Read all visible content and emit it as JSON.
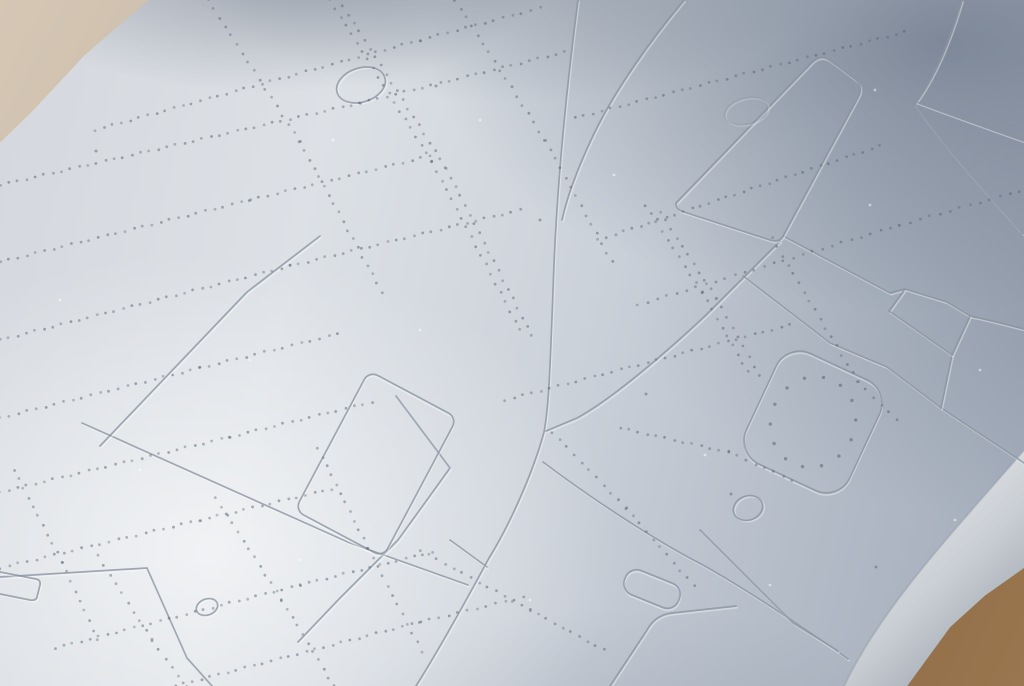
{
  "scene": {
    "subject": "macro-photo-of-grey-plastic-scale-model-part",
    "surface": "light grey injection-moulded plastic with engraved panel lines and recessed rivet rows",
    "backdrop_top_left": "blurred beige-grey tabletop",
    "backdrop_bottom_right": "warm brown tabletop"
  },
  "palette": {
    "surface_bright": "#e0e4e9",
    "surface_mid": "#ccd2da",
    "surface_shadow": "#97a1b0",
    "engraved_line": "#8a93a0",
    "emboss_highlight": "#ffffff",
    "rivet": "#59636f",
    "backdrop_beige": "#d2c4b1",
    "backdrop_shadow": "#6f6c6a",
    "table_brown": "#7d5c3c",
    "table_brown_light": "#99764e",
    "edge_band_stops": [
      [
        "0",
        "#e7e9eb"
      ],
      [
        "0.5",
        "#c9ced4"
      ],
      [
        "1",
        "#9ba2ab"
      ]
    ],
    "edge_crease": "#97a0ab",
    "edge_outline": "#8d949c"
  },
  "geometry": {
    "edge": {
      "band": "M1024,450 C955,530 882,606 844,686 L910,686 C950,632 988,598 1024,576 Z",
      "band_grad": [
        868,
        515,
        1005,
        660
      ],
      "crease": "M1024,450 C955,530 882,606 844,686",
      "outer": "M1024,576 C988,598 950,632 910,686"
    },
    "panel_lines": [
      "M578,0 C566,92 556,192 553,292 C550,368 549,406 544,432 C533,473 509,526 489,558 C468,597 438,651 416,686",
      "M684,0 C652,38 613,92 591,140 C577,170 567,197 562,220",
      "M780,241 L706,315 C672,347 614,398 577,418 L546,431",
      "M783,236 L890,293 L904,289",
      "M743,276 L830,343 L887,367 L941,408 L1024,463",
      "M952,355 L941,408",
      "M970,316 C990,320 1008,325 1024,329",
      "M962,0 C952,34 938,72 916,102",
      "M916,102 C948,114 990,129 1024,141",
      "M914,104 C941,143 986,193 1023,234",
      "M82,423 L350,543 L468,585",
      "M396,396 L450,468 L398,540 L340,598 L298,642",
      "M100,446 L247,292 L320,236",
      "M0,577 L147,568 L187,658 L212,686",
      "M543,462 C592,499 656,541 701,564 C746,589 801,626 848,659",
      "M700,530 L793,623 L838,651",
      "M450,540 L487,567",
      "M0,572 L36,579 Q41,580 40,585 L37,597 Q36,601 30,600 L0,594"
    ],
    "embossed_paths": [
      {
        "name": "raised-panel-parallelogram",
        "d": "M676,203 L812,62 Q820,54 829,60 L856,80 Q863,86 859,95 L783,236 Q779,243 770,240 L684,212 Q676,210 676,203 Z"
      },
      {
        "name": "wing-root-pentagon",
        "d": "M905,289 L947,302 L970,316 L952,355 L889,311 Z"
      },
      {
        "name": "bottom-panel-corner",
        "d": "M736,606 L672,613 Q655,615 647,630 L610,686"
      }
    ],
    "rrects": [
      {
        "name": "access-hatch",
        "cx": 813,
        "cy": 422,
        "w": 114,
        "h": 122,
        "rot": 25,
        "rx": 26
      },
      {
        "name": "panel-rectangle",
        "cx": 376,
        "cy": 464,
        "w": 100,
        "h": 158,
        "rot": 28,
        "rx": 10
      },
      {
        "name": "small-slot",
        "cx": 652,
        "cy": 589,
        "w": 58,
        "h": 26,
        "rot": 22,
        "rx": 12
      }
    ],
    "ellipses": [
      {
        "name": "oval-opening",
        "cx": 361,
        "cy": 85,
        "rx": 25,
        "ry": 17,
        "rot": -18
      },
      {
        "name": "small-circle",
        "cx": 748,
        "cy": 508,
        "rx": 15,
        "ry": 12,
        "rot": -20
      },
      {
        "name": "tiny-oval",
        "cx": 207,
        "cy": 607,
        "rx": 11,
        "ry": 8,
        "rot": -20
      },
      {
        "name": "surface-bump",
        "cx": 746,
        "cy": 111,
        "rx": 22,
        "ry": 13,
        "rot": -15,
        "faint": true
      }
    ],
    "hatch_rivets": {
      "cx": 813,
      "cy": 422,
      "rx": 42,
      "ry": 46,
      "rot": 25,
      "count": 14,
      "r": 1.7
    },
    "rivet_rows": [
      {
        "step": 9,
        "pts": [
          [
            95,
            130
          ],
          [
            420,
            40
          ],
          [
            540,
            8
          ]
        ]
      },
      {
        "step": 9,
        "pts": [
          [
            0,
            185
          ],
          [
            360,
            103
          ],
          [
            565,
            52
          ]
        ]
      },
      {
        "step": 9,
        "pts": [
          [
            0,
            262
          ],
          [
            250,
            200
          ],
          [
            430,
            156
          ]
        ]
      },
      {
        "step": 9,
        "pts": [
          [
            0,
            340
          ],
          [
            290,
            266
          ],
          [
            520,
            210
          ]
        ]
      },
      {
        "step": 9,
        "pts": [
          [
            0,
            418
          ],
          [
            200,
            368
          ],
          [
            338,
            334
          ]
        ]
      },
      {
        "step": 9,
        "pts": [
          [
            0,
            492
          ],
          [
            230,
            437
          ],
          [
            372,
            402
          ]
        ]
      },
      {
        "step": 9,
        "pts": [
          [
            0,
            568
          ],
          [
            200,
            520
          ],
          [
            332,
            489
          ]
        ]
      },
      {
        "step": 9,
        "pts": [
          [
            55,
            648
          ],
          [
            300,
            585
          ],
          [
            432,
            552
          ]
        ]
      },
      {
        "step": 9,
        "pts": [
          [
            175,
            686
          ],
          [
            420,
            622
          ],
          [
            524,
            597
          ]
        ]
      },
      {
        "step": 9,
        "pts": [
          [
            575,
            118
          ],
          [
            905,
            32
          ]
        ]
      },
      {
        "step": 9,
        "pts": [
          [
            598,
            240
          ],
          [
            880,
            146
          ]
        ]
      },
      {
        "step": 10,
        "pts": [
          [
            638,
            305
          ],
          [
            900,
            225
          ],
          [
            1020,
            191
          ]
        ]
      },
      {
        "step": 9,
        "pts": [
          [
            505,
            400
          ],
          [
            790,
            325
          ]
        ]
      },
      {
        "step": 9,
        "pts": [
          [
            420,
            550
          ],
          [
            530,
            610
          ],
          [
            604,
            650
          ]
        ]
      },
      {
        "step": 9,
        "pts": [
          [
            620,
            428
          ],
          [
            728,
            452
          ],
          [
            792,
            480
          ]
        ]
      },
      {
        "step": 10,
        "pts": [
          [
            208,
            0
          ],
          [
            300,
            142
          ],
          [
            382,
            292
          ]
        ]
      },
      {
        "step": 10,
        "pts": [
          [
            330,
            0
          ],
          [
            432,
            162
          ],
          [
            520,
            330
          ]
        ]
      },
      {
        "step": 10,
        "pts": [
          [
            343,
            6
          ],
          [
            446,
            168
          ],
          [
            532,
            336
          ]
        ]
      },
      {
        "step": 10,
        "pts": [
          [
            455,
            0
          ],
          [
            545,
            140
          ],
          [
            612,
            262
          ]
        ]
      },
      {
        "step": 10,
        "pts": [
          [
            645,
            205
          ],
          [
            702,
            292
          ],
          [
            748,
            372
          ]
        ]
      },
      {
        "step": 10,
        "pts": [
          [
            660,
            212
          ],
          [
            716,
            298
          ],
          [
            760,
            376
          ]
        ]
      },
      {
        "step": 10,
        "pts": [
          [
            772,
            238
          ],
          [
            858,
            382
          ],
          [
            897,
            420
          ]
        ]
      },
      {
        "step": 10,
        "pts": [
          [
            98,
            556
          ],
          [
            152,
            640
          ],
          [
            186,
            686
          ]
        ]
      },
      {
        "step": 10,
        "pts": [
          [
            216,
            498
          ],
          [
            282,
            600
          ],
          [
            334,
            686
          ]
        ]
      },
      {
        "step": 10,
        "pts": [
          [
            318,
            448
          ],
          [
            368,
            548
          ],
          [
            422,
            652
          ]
        ]
      },
      {
        "step": 10,
        "pts": [
          [
            552,
            432
          ],
          [
            626,
            508
          ],
          [
            694,
            586
          ]
        ]
      },
      {
        "step": 10,
        "pts": [
          [
            14,
            470
          ],
          [
            62,
            562
          ],
          [
            98,
            640
          ]
        ]
      }
    ],
    "specks_light": [
      [
        333,
        140
      ],
      [
        614,
        175
      ],
      [
        870,
        205
      ],
      [
        420,
        330
      ],
      [
        250,
        360
      ],
      [
        705,
        455
      ],
      [
        955,
        520
      ],
      [
        530,
        600
      ],
      [
        140,
        470
      ],
      [
        60,
        300
      ],
      [
        875,
        90
      ],
      [
        980,
        370
      ],
      [
        300,
        560
      ],
      [
        480,
        120
      ],
      [
        770,
        585
      ]
    ],
    "specks_dark": [
      [
        731,
        494
      ],
      [
        646,
        394
      ],
      [
        876,
        567
      ],
      [
        436,
        86
      ],
      [
        96,
        151
      ],
      [
        540,
        220
      ]
    ]
  }
}
